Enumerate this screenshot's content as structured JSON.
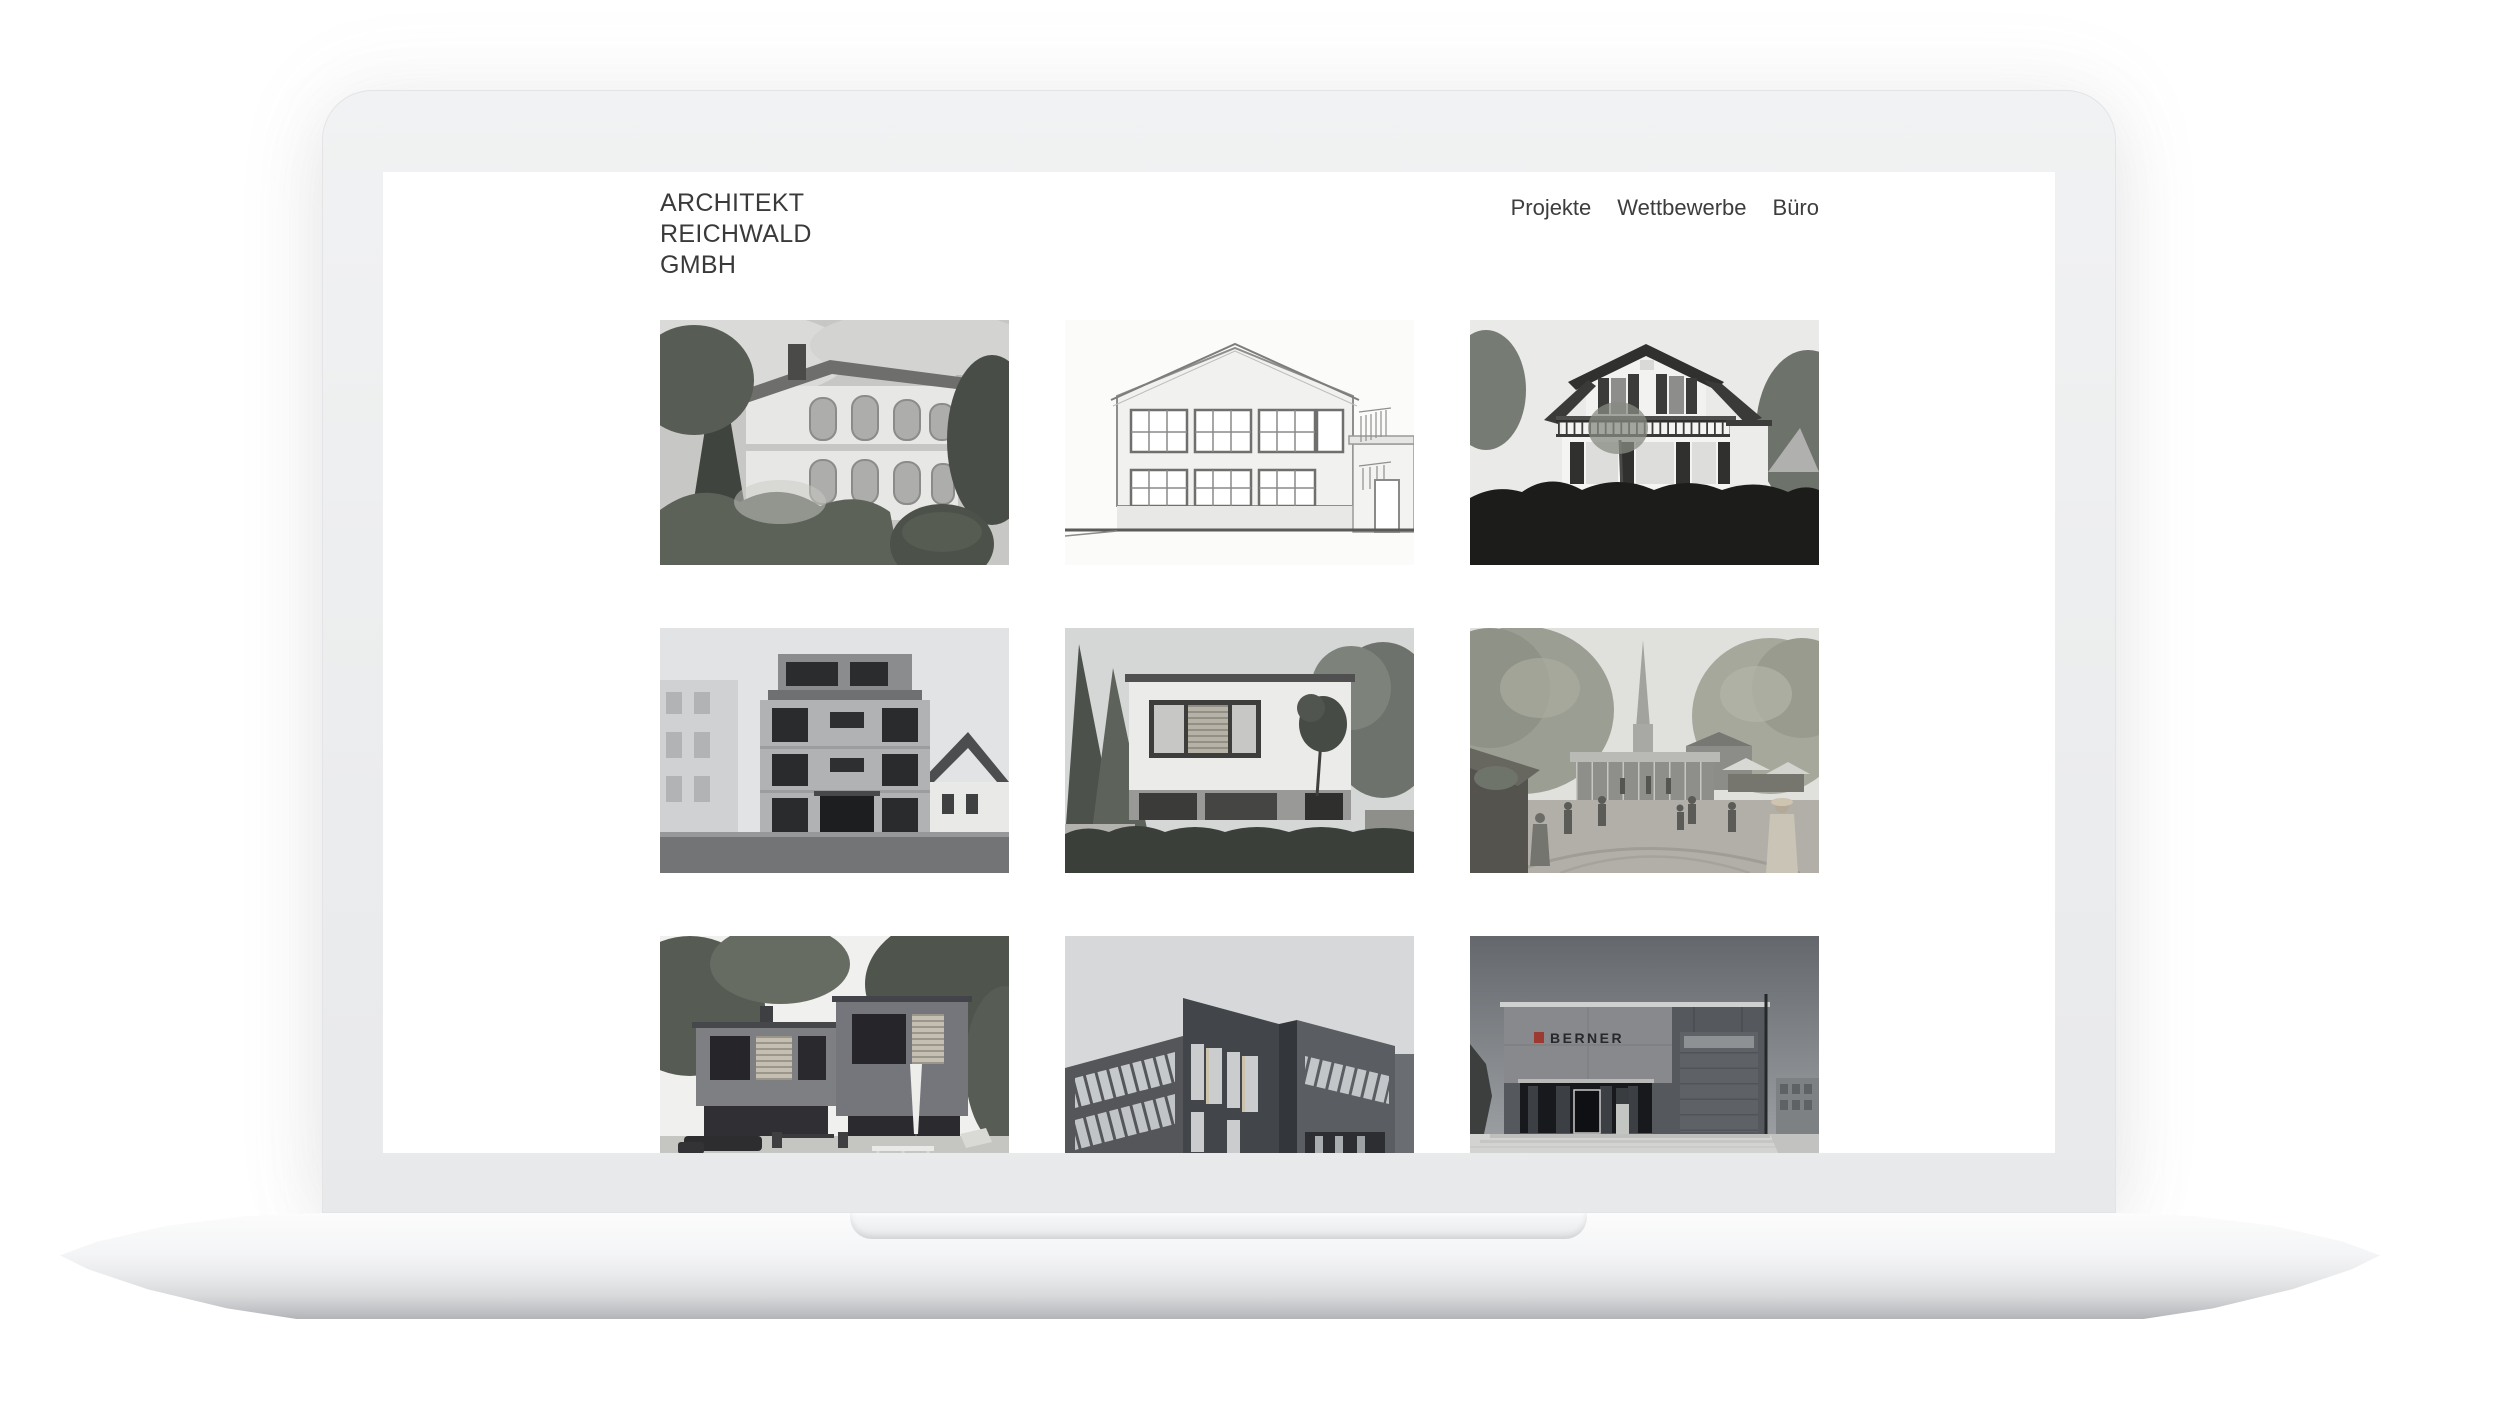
{
  "brand": {
    "line1": "ARCHITEKT",
    "line2": "REICHWALD",
    "line3": "GMBH"
  },
  "nav": {
    "items": [
      {
        "label": "Projekte"
      },
      {
        "label": "Wettbewerbe"
      },
      {
        "label": "Büro"
      }
    ]
  },
  "gallery": {
    "items": [
      {
        "name": "historic-villa-photo",
        "description": "Historic villa with arched windows among dark trees"
      },
      {
        "name": "facade-elevation-drawing",
        "description": "Architectural elevation line drawing of a gabled house"
      },
      {
        "name": "white-villa-photo",
        "description": "White villa with balcony and shutters behind a dark hedge"
      },
      {
        "name": "apartment-building-photo",
        "description": "Modern flat-roof apartment building between older houses"
      },
      {
        "name": "cubic-house-photo",
        "description": "Modern white cubic house behind a garden hedge"
      },
      {
        "name": "market-square-rendering",
        "description": "Rendering of a market square pavilion with church spire"
      },
      {
        "name": "garden-house-photo",
        "description": "Dark grey modern house with garden terrace and parasol"
      },
      {
        "name": "brick-office-rendering",
        "description": "Rendering of a dark brick office building"
      },
      {
        "name": "berner-building-photo",
        "description": "BERNER company building with glass entrance",
        "facade_text": "BERNER"
      }
    ]
  },
  "colors": {
    "page_bg": "#ffffff",
    "laptop_body": "#eceded",
    "screen_bg": "#ffffff",
    "logo_text": "#3a3a3a",
    "nav_text": "#3d3d3d",
    "berner_logo_red": "#9c3a31"
  }
}
